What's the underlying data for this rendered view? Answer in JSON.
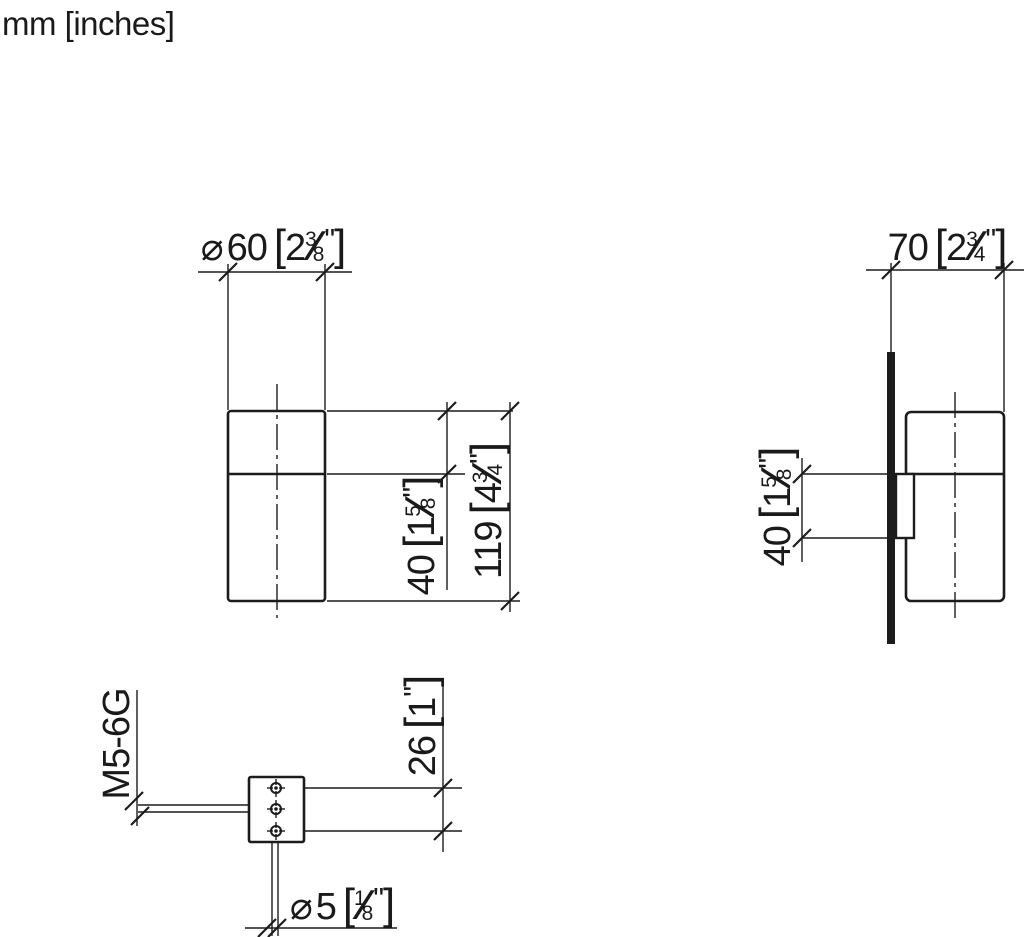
{
  "meta": {
    "units_note": "mm [inches]",
    "line_color": "#1c1c1c",
    "background": "#ffffff"
  },
  "dims": {
    "d60": {
      "prefix": "⌀",
      "mm": "60",
      "open": "[",
      "whole": "2",
      "num": "3",
      "slash": "∕",
      "den": "8",
      "inch": "\"",
      "close": "]"
    },
    "d70": {
      "mm": "70",
      "open": "[",
      "whole": "2",
      "num": "3",
      "slash": "∕",
      "den": "4",
      "inch": "\"",
      "close": "]"
    },
    "d40_front": {
      "mm": "40",
      "open": "[",
      "whole": "1",
      "num": "5",
      "slash": "∕",
      "den": "8",
      "inch": "\"",
      "close": "]"
    },
    "d119": {
      "mm": "119",
      "open": "[",
      "whole": "4",
      "num": "3",
      "slash": "∕",
      "den": "4",
      "inch": "\"",
      "close": "]"
    },
    "d40_side": {
      "mm": "40",
      "open": "[",
      "whole": "1",
      "num": "5",
      "slash": "∕",
      "den": "8",
      "inch": "\"",
      "close": "]"
    },
    "d26": {
      "mm": "26",
      "open": "[",
      "whole": "1",
      "inch": "\"",
      "close": "]"
    },
    "d5": {
      "prefix": "⌀",
      "mm": "5",
      "open": "[",
      "num": "1",
      "slash": "∕",
      "den": "8",
      "inch": "\"",
      "close": "]"
    },
    "thread": {
      "label": "M5-6G"
    }
  }
}
